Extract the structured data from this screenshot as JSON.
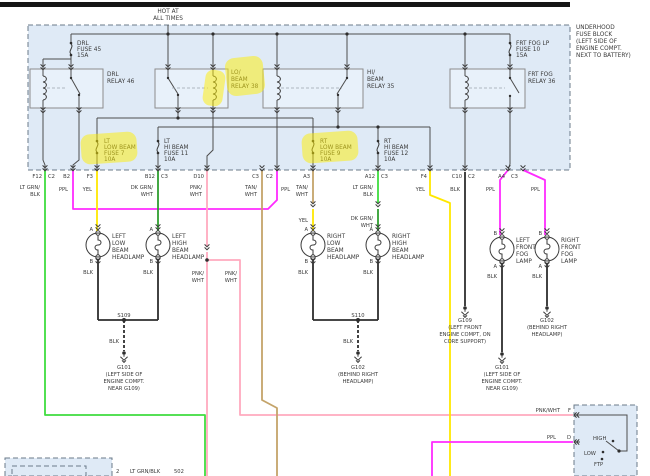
{
  "colors": {
    "lt_grn": "#3fdc3f",
    "dk_grn": "#2f9e2f",
    "ppl": "#ff2bff",
    "yel": "#ffe800",
    "pnk": "#ffaabf",
    "tan": "#c4a46a",
    "blk": "#2e2e2e",
    "highlight": "#ffee00"
  },
  "power": {
    "hot": [
      "HOT AT",
      "ALL TIMES"
    ]
  },
  "block": {
    "name": [
      "UNDERHOOD",
      "FUSE BLOCK",
      "(LEFT SIDE OF",
      "ENGINE COMPT.",
      "NEXT TO BATTERY)"
    ]
  },
  "fuses": {
    "drl": [
      "DRL",
      "FUSE 45",
      "15A"
    ],
    "fog": [
      "FRT FOG LP",
      "FUSE 10",
      "15A"
    ],
    "lt_low": [
      "LT",
      "LOW BEAM",
      "FUSE 7",
      "10A"
    ],
    "lt_hi": [
      "LT",
      "HI BEAM",
      "FUSE 11",
      "10A"
    ],
    "rt_low": [
      "RT",
      "LOW BEAM",
      "FUSE 9",
      "10A"
    ],
    "rt_hi": [
      "RT",
      "HI BEAM",
      "FUSE 12",
      "10A"
    ]
  },
  "relays": {
    "drl": [
      "DRL",
      "RELAY 46"
    ],
    "lo": [
      "LO/",
      "BEAM",
      "RELAY 38"
    ],
    "hi": [
      "HI/",
      "BEAM",
      "RELAY 35"
    ],
    "fog": [
      "FRT FOG",
      "RELAY 36"
    ]
  },
  "pins": {
    "f12": "F12",
    "c2": "C2",
    "b2": "B2",
    "f3": "F3",
    "b12": "B12",
    "c3": "C3",
    "d10": "D10",
    "a3": "A3",
    "a12": "A12",
    "f4": "F4",
    "c10": "C10",
    "a4": "A4"
  },
  "wires": {
    "lt_grn": [
      "LT GRN/",
      "BLK"
    ],
    "dk_grn": [
      "DK GRN/",
      "WHT"
    ],
    "pnk": [
      "PNK/",
      "WHT"
    ],
    "tan": [
      "TAN/",
      "WHT"
    ],
    "ppl": "PPL",
    "yel": "YEL",
    "blk": "BLK",
    "pnk_wht": "PNK/WHT"
  },
  "lamps": {
    "llb": [
      "LEFT",
      "LOW",
      "BEAM",
      "HEADLAMP"
    ],
    "lhb": [
      "LEFT",
      "HIGH",
      "BEAM",
      "HEADLAMP"
    ],
    "rlb": [
      "RIGHT",
      "LOW",
      "BEAM",
      "HEADLAMP"
    ],
    "rhb": [
      "RIGHT",
      "HIGH",
      "BEAM",
      "HEADLAMP"
    ],
    "lff": [
      "LEFT",
      "FRONT",
      "FOG",
      "LAMP"
    ],
    "rff": [
      "RIGHT",
      "FRONT",
      "FOG",
      "LAMP"
    ],
    "term_a": "A",
    "term_b": "B"
  },
  "splices": {
    "s109": "S109",
    "s110": "S110"
  },
  "grounds": {
    "g101": [
      "G101",
      "(LEFT SIDE OF",
      "ENGINE COMPT.",
      "NEAR G109)"
    ],
    "g102": [
      "G102",
      "(BEHIND RIGHT",
      "HEADLAMP)"
    ],
    "g109": [
      "G109",
      "(LEFT FRONT",
      "ENGINE COMPT, ON",
      "CORE SUPPORT)"
    ]
  },
  "dimmer": {
    "f": "F",
    "d": "D",
    "high": "HIGH",
    "low": "LOW",
    "ftp": "FTP"
  },
  "bottom": {
    "pin": "2",
    "wire": "LT GRN/BLK",
    "circuit": "502"
  }
}
